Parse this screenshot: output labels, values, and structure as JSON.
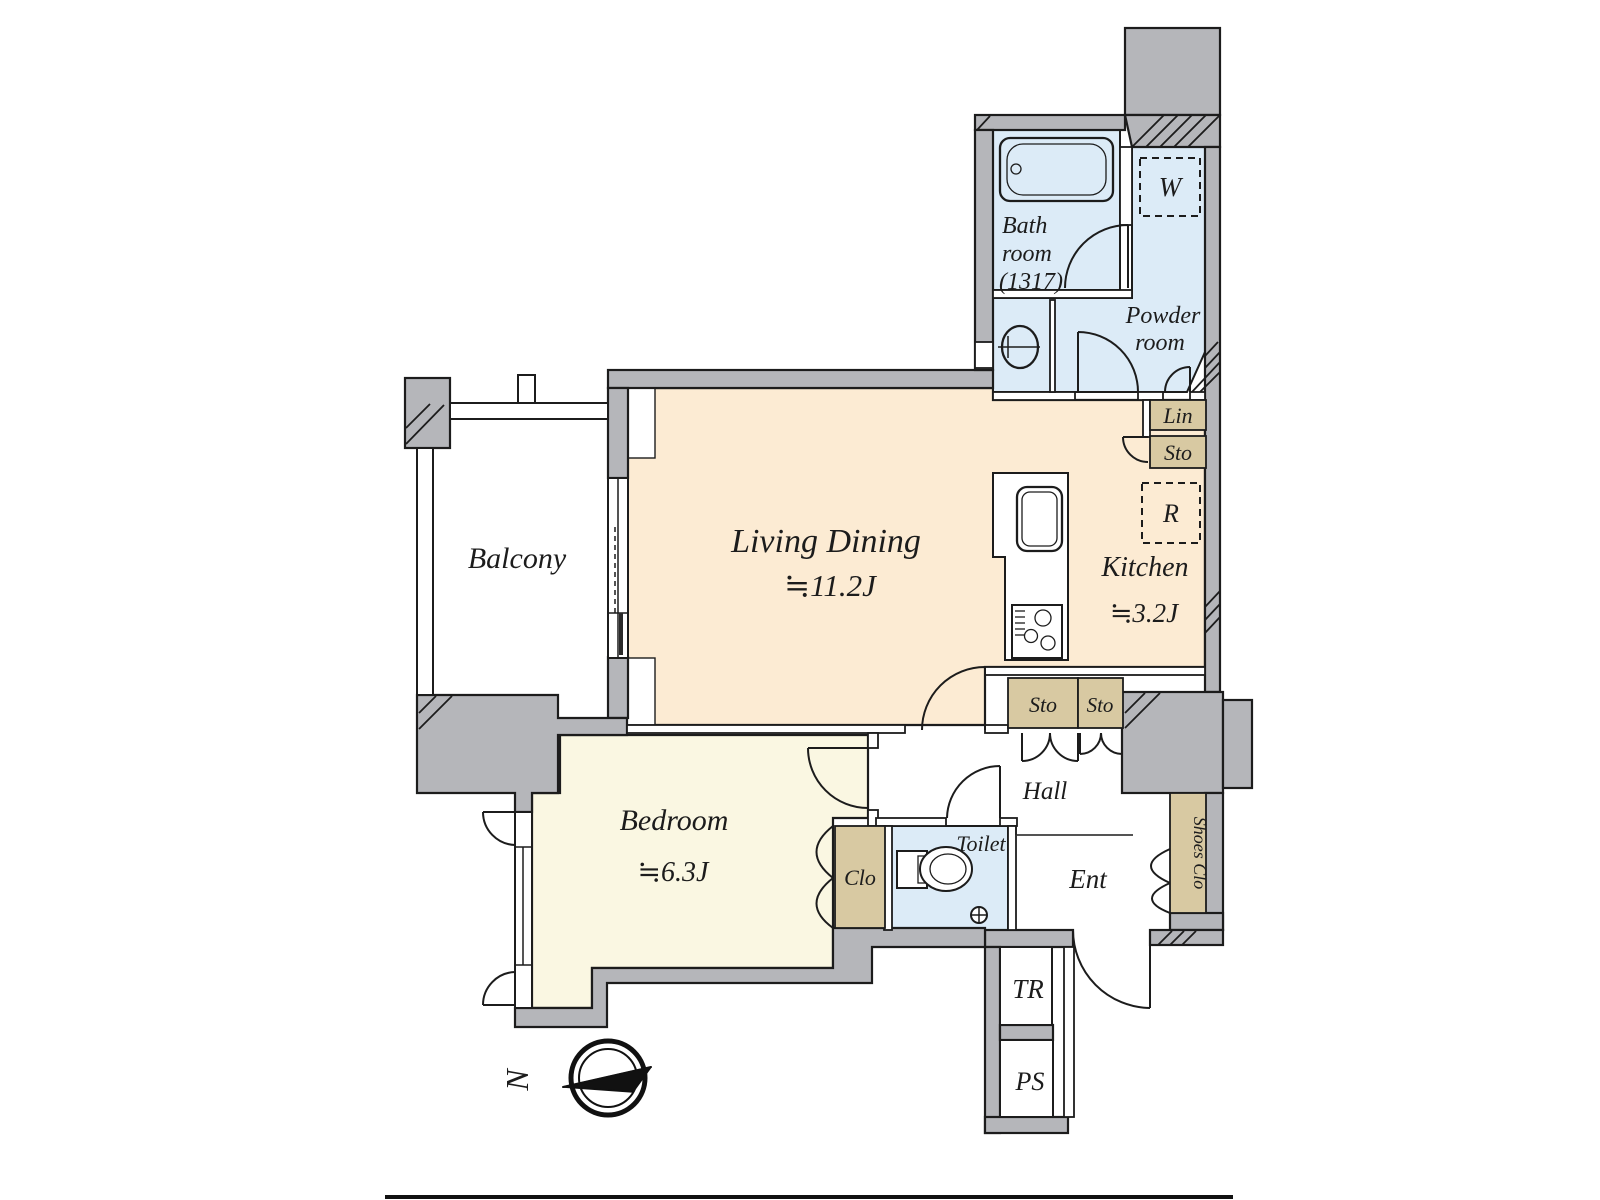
{
  "plan": {
    "rooms": {
      "balcony": {
        "name": "Balcony"
      },
      "living_dining": {
        "name": "Living Dining",
        "size": "≒11.2J"
      },
      "kitchen": {
        "name": "Kitchen",
        "size": "≒3.2J"
      },
      "bedroom": {
        "name": "Bedroom",
        "size": "≒6.3J"
      },
      "bathroom": {
        "line1": "Bath",
        "line2": "room",
        "line3": "(1317)"
      },
      "powder_room": {
        "line1": "Powder",
        "line2": "room"
      },
      "hall": {
        "name": "Hall"
      },
      "toilet": {
        "name": "Toilet"
      },
      "entrance": {
        "name": "Ent"
      }
    },
    "storage": {
      "closet": "Clo",
      "shoes_closet": "Shoes Clo",
      "linen": "Lin",
      "kitchen_storage": "Sto",
      "hall_storage_left": "Sto",
      "hall_storage_right": "Sto"
    },
    "markers": {
      "washing_machine": "W",
      "refrigerator": "R",
      "trunk_room": "TR",
      "pipe_space": "PS"
    },
    "compass": {
      "north": "N"
    },
    "colors": {
      "wall": "#b5b6ba",
      "living_kitchen_floor": "#fcebd3",
      "bedroom_floor": "#faf7e2",
      "wet_area_floor": "#dcebf7",
      "storage": "#d8c9a2",
      "outline": "#1c1c1c"
    }
  }
}
